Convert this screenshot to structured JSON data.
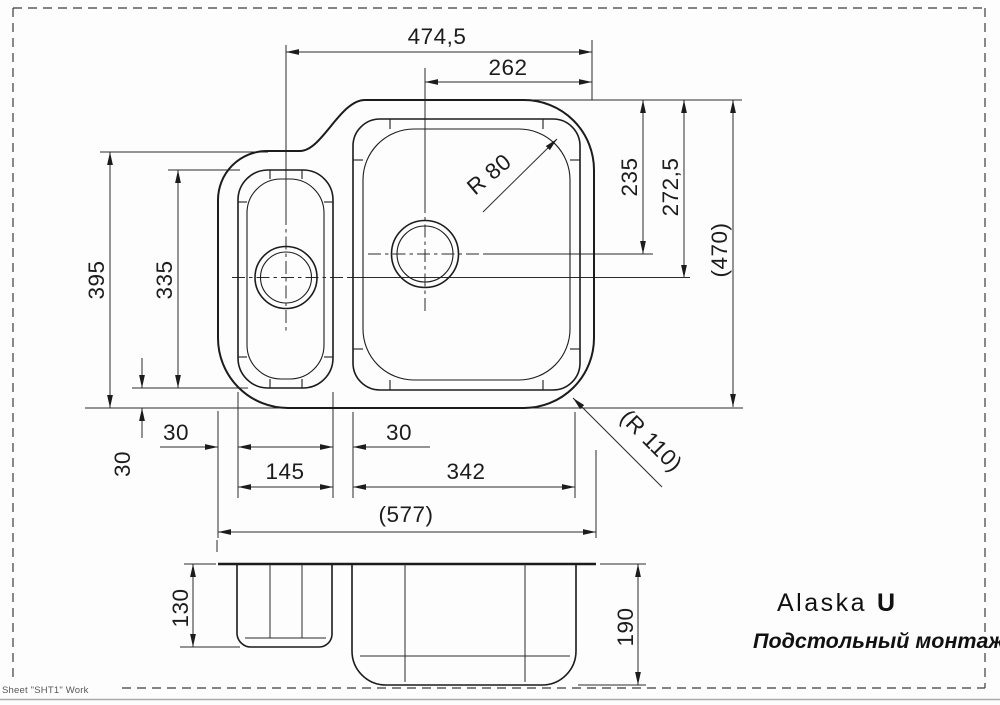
{
  "drawing": {
    "product": {
      "name": "Alaska",
      "variant": "U",
      "mounting_type": "Подстольный монтаж"
    },
    "sheet_label": "Sheet \"SHT1\" Work",
    "colors": {
      "line": "#1c1c1c",
      "background": "#fdfdfd",
      "border_dash": "#3c3c3c",
      "sheet_text": "#575757"
    },
    "plan": {
      "dim_top_width": "474,5",
      "dim_drain_offset": "262",
      "dim_left_height": "395",
      "dim_small_bowl_height": "335",
      "dim_bowl_corner_radius": "R 80",
      "dim_large_drain_depth": "235",
      "dim_small_drain_depth": "272,5",
      "dim_overall_depth": "(470)",
      "dim_bottom_offset": "30",
      "dim_left_edge_gap": "30",
      "dim_small_bowl_width": "145",
      "dim_bowl_gap": "30",
      "dim_large_bowl_width": "342",
      "dim_overall_width": "(577)",
      "dim_outer_corner_radius": "(R 110)"
    },
    "section": {
      "dim_small_bowl_depth": "130",
      "dim_large_bowl_depth": "190"
    }
  }
}
